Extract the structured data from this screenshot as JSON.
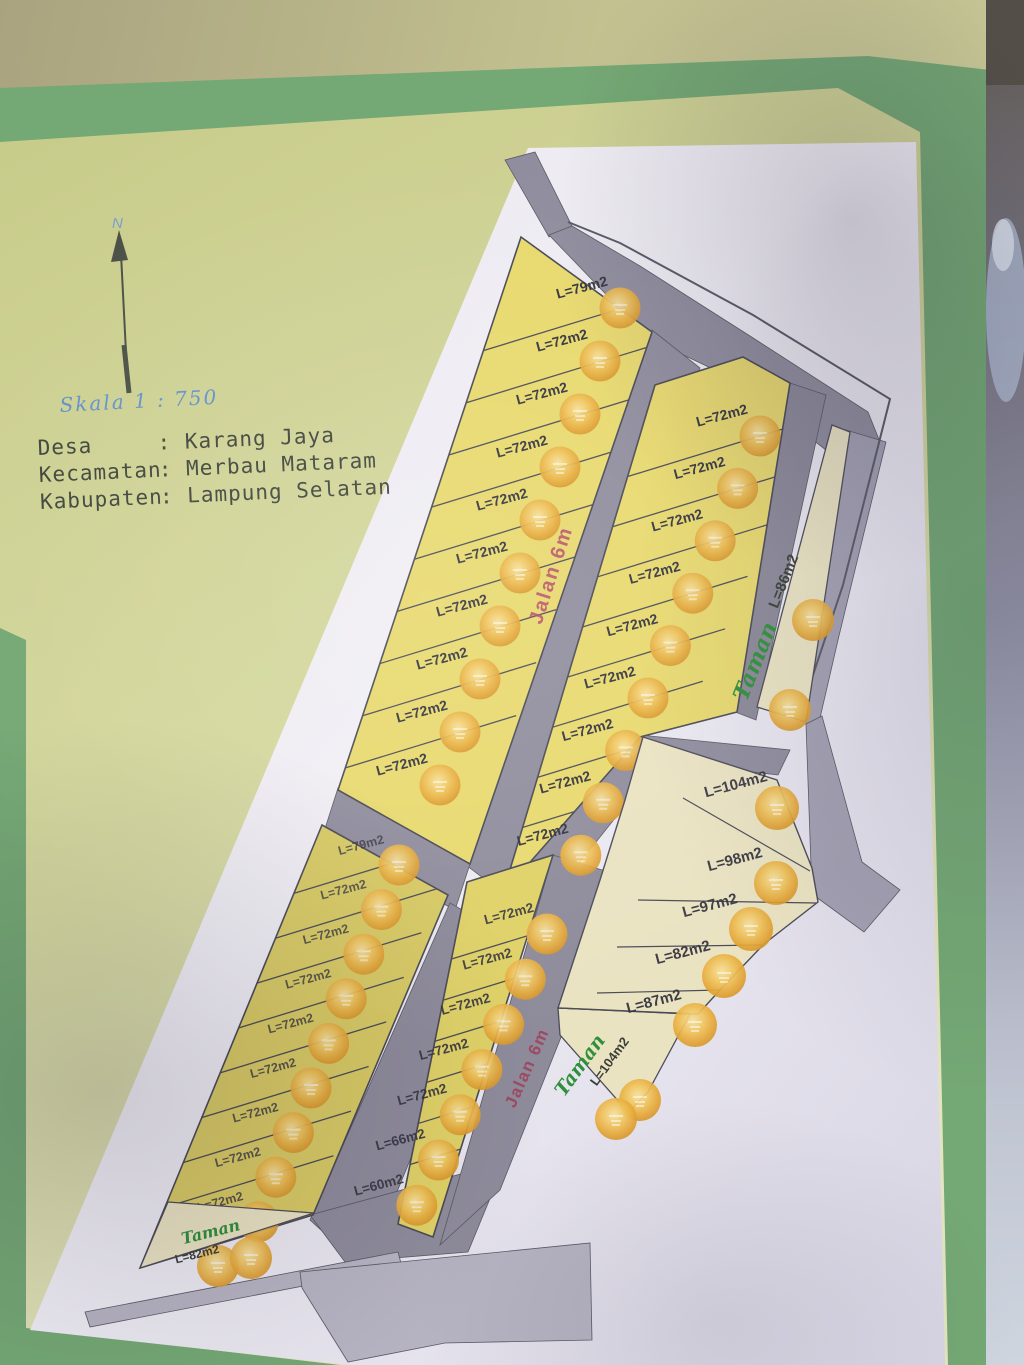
{
  "document": {
    "kind": "housing site plan photo",
    "location_rows": [
      {
        "label": "Desa",
        "value": ": Karang Jaya"
      },
      {
        "label": "Kecamatan",
        "value": ": Merbau Mataram"
      },
      {
        "label": "Kabupaten",
        "value": ": Lampung Selatan"
      }
    ],
    "scale_text": "Skala 1 : 750",
    "north_label": "N"
  },
  "roads": {
    "main_label": "Jalan 6m",
    "secondary_label": "Jalan 6m"
  },
  "parks": {
    "right": {
      "name": "Taman",
      "size": "L=86m2"
    },
    "bottom": {
      "name": "Taman",
      "size": "L=104m2"
    },
    "southwest": {
      "name": "Taman",
      "size": "L=82m2"
    }
  },
  "columns": {
    "a": [
      "L=79m2",
      "L=72m2",
      "L=72m2",
      "L=72m2",
      "L=72m2",
      "L=72m2",
      "L=72m2",
      "L=72m2",
      "L=72m2",
      "L=72m2"
    ],
    "b": [
      "L=72m2",
      "L=72m2",
      "L=72m2",
      "L=72m2",
      "L=72m2",
      "L=72m2",
      "L=72m2",
      "L=72m2",
      "L=72m2"
    ],
    "d": [
      "L=79m2",
      "L=72m2",
      "L=72m2",
      "L=72m2",
      "L=72m2",
      "L=72m2",
      "L=72m2",
      "L=72m2",
      "L=72m2"
    ],
    "e": [
      "L=72m2",
      "L=72m2",
      "L=72m2",
      "L=72m2",
      "L=72m2",
      "L=66m2",
      "L=60m2"
    ],
    "f": [
      "L=104m2",
      "L=98m2",
      "L=97m2",
      "L=82m2",
      "L=87m2"
    ]
  },
  "badges": {
    "meaning": "orange sold sticker",
    "count": 46
  },
  "colors": {
    "plot_yellow": "#e8d96e",
    "plot_cream": "#eae3c2",
    "road_gray": "#908d9e",
    "road_gray_dark": "#8b8898",
    "road_gray_light": "#a3a0b2",
    "park_text_green": "#2f8f3a",
    "road_text_red": "#b5476a",
    "frame_green": "#74a874",
    "page_yellow_green": "#ccd08c",
    "paper_white": "#edebf3",
    "badge_orange": "#e8a93a",
    "scale_blue": "#6292cc"
  }
}
